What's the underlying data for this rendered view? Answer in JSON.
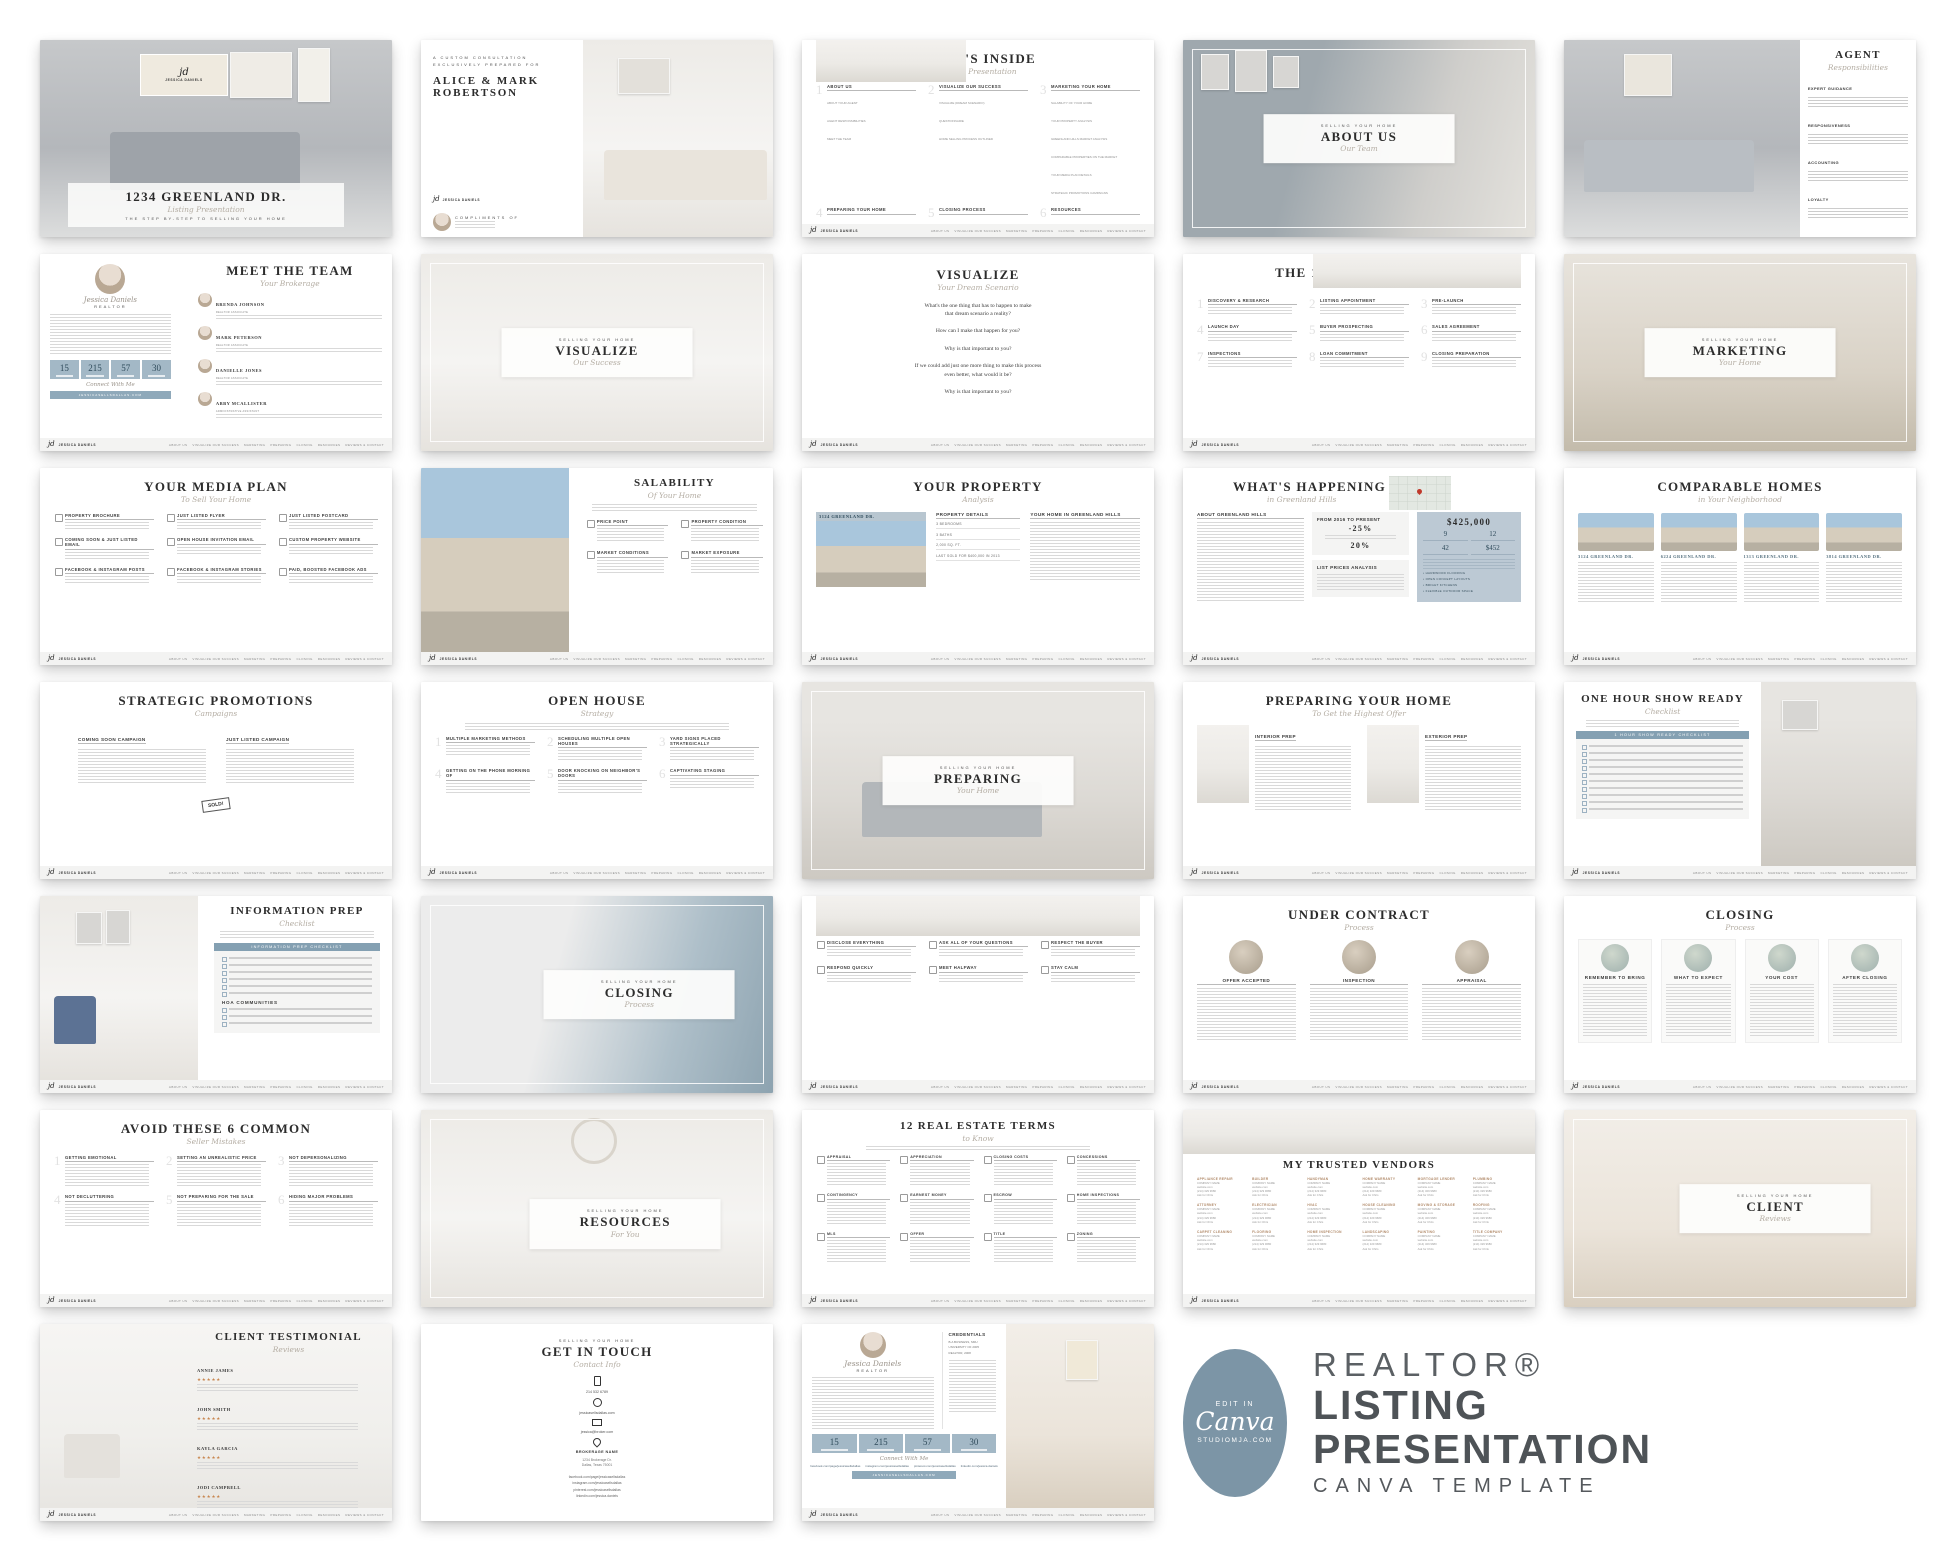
{
  "shared": {
    "eyebrow": "SELLING YOUR HOME",
    "connect": "Connect With Me",
    "stats": [
      "15",
      "215",
      "57",
      "30"
    ]
  },
  "logo": {
    "initials": "jd",
    "name": "JESSICA DANIELS"
  },
  "footer_nav": [
    "ABOUT US",
    "VISUALIZE OUR SUCCESS",
    "MARKETING",
    "PREPARING",
    "CLOSING",
    "RESOURCES",
    "REVIEWS & CONTACT"
  ],
  "branding": {
    "badge_top": "EDIT IN",
    "badge_logo": "Canva",
    "badge_site": "STUDIOMJA.COM",
    "line1": "REALTOR®",
    "line2": "LISTING",
    "line3": "PRESENTATION",
    "line4": "CANVA TEMPLATE"
  },
  "slides": {
    "cover": {
      "title": "1234 GREENLAND DR.",
      "script": "Listing Presentation",
      "tagline": "THE STEP BY-STEP TO SELLING YOUR HOME"
    },
    "intro": {
      "eyebrow": "A CUSTOM CONSULTATION\nEXCLUSIVELY PREPARED FOR",
      "name1": "ALICE & MARK",
      "name2": "ROBERTSON",
      "compliments": "COMPLIMENTS OF",
      "agent": "Jessica Daniels"
    },
    "whats_inside": {
      "title": "WHAT'S INSIDE",
      "script": "Sellers Presentation",
      "items": [
        {
          "h": "ABOUT US",
          "sub": "ABOUT YOUR AGENT\nAGENT RESPONSIBILITIES\nMEET THE TEAM"
        },
        {
          "h": "VISUALIZE OUR SUCCESS",
          "sub": "VISUALIZE (DREAM SCENARIO)\nQUESTIONNAIRE\nHOME SELLING PROCESS OUTLINED"
        },
        {
          "h": "MARKETING YOUR HOME",
          "sub": "SALABILITY OF YOUR HOME\nYOUR PROPERTY ANALYSIS\nGREENLAND HILLS MARKET ANALYSIS\nCOMPARABLE PROPERTIES ON THE MARKET\nYOUR MEDIA PLAN DETAILS\nSTRATEGIC PROMOTIONS CAMPAIGNS"
        },
        {
          "h": "PREPARING YOUR HOME",
          "sub": "HOW TO PREP INTERIOR & EXTERIOR\nONE HOUR SHOW READY\nINFORMATION PREP"
        },
        {
          "h": "CLOSING PROCESS",
          "sub": "NEGOTIATING THE SALE\nCLOSING 101\nUNDER CONTRACT PROCESS"
        },
        {
          "h": "RESOURCES",
          "sub": "REAL ESTATE TERMS TO KNOW\nTRUSTED VENDORS RESOURCES"
        },
        {
          "h": "REVIEWS & CONTACT",
          "sub": "OUR AWESOME CLIENTS REVIEWS\nCONTACT INFORMATION"
        }
      ]
    },
    "about_us": {
      "title": "ABOUT US",
      "script": "Our Team"
    },
    "agent_resp": {
      "title": "AGENT",
      "script": "Responsibilities",
      "sections": [
        "EXPERT GUIDANCE",
        "RESPONSIVENESS",
        "ACCOUNTING",
        "LOYALTY"
      ]
    },
    "meet_team": {
      "title": "MEET THE TEAM",
      "script": "Your Brokerage",
      "agent": "Jessica Daniels",
      "role": "REALTOR",
      "members": [
        {
          "name": "BRENDA JOHNSON",
          "role": "REALTOR ASSOCIATE"
        },
        {
          "name": "MARK PETERSON",
          "role": "REALTOR ASSOCIATE"
        },
        {
          "name": "DANIELLE JONES",
          "role": "REALTOR ASSOCIATE"
        },
        {
          "name": "ABBY MCALLISTER",
          "role": "ADMINISTRATIVE ASSISTANT"
        }
      ]
    },
    "visualize_photo": {
      "title": "VISUALIZE",
      "script": "Our Success"
    },
    "visualize_q": {
      "title": "VISUALIZE",
      "script": "Your Dream Scenario",
      "questions": [
        "What's the one thing that has to happen to make\nthat dream scenario a reality?",
        "How can I make that happen for you?",
        "Why is that important to you?",
        "If we could add just one more thing to make this process\neven better, what would it be?",
        "Why is that important to you?"
      ]
    },
    "ten_step": {
      "title": "THE 10-STEP PROCESS",
      "script": "To Sell Your Home",
      "steps": [
        "DISCOVERY & RESEARCH",
        "LISTING APPOINTMENT",
        "PRE-LAUNCH",
        "LAUNCH DAY",
        "BUYER PROSPECTING",
        "SALES AGREEMENT",
        "INSPECTIONS",
        "LOAN COMMITMENT",
        "CLOSING PREPARATION"
      ]
    },
    "marketing_photo": {
      "title": "MARKETING",
      "script": "Your Home"
    },
    "media_plan": {
      "title": "YOUR MEDIA PLAN",
      "script": "To Sell Your Home",
      "items": [
        "PROPERTY BROCHURE",
        "JUST LISTED FLYER",
        "JUST LISTED POSTCARD",
        "COMING SOON & JUST LISTED EMAIL",
        "OPEN HOUSE INVITATION EMAIL",
        "CUSTOM PROPERTY WEBSITE",
        "FACEBOOK & INSTAGRAM POSTS",
        "FACEBOOK & INSTAGRAM STORIES",
        "PAID, BOOSTED FACEBOOK ADS"
      ]
    },
    "salability": {
      "title": "SALABILITY",
      "script": "Of Your Home",
      "items": [
        "PRICE POINT",
        "PROPERTY CONDITION",
        "MARKET CONDITIONS",
        "MARKET EXPOSURE"
      ]
    },
    "your_property": {
      "title": "YOUR PROPERTY",
      "script": "Analysis",
      "address": "3124 GREENLAND DR.",
      "details_h": "PROPERTY DETAILS",
      "details": [
        "3 BEDROOMS",
        "3 BATHS",
        "2,000 SQ. FT.",
        "LAST SOLD FOR $400,000 IN 2013"
      ],
      "right_h": "YOUR HOME IN GREENLAND HILLS"
    },
    "whats_happening": {
      "title": "WHAT'S HAPPENING",
      "script": "in Greenland Hills",
      "about_h": "ABOUT GREENLAND HILLS",
      "from_h": "FROM 2016 TO PRESENT",
      "stat1": "-25%",
      "stat2": "20%",
      "list_h": "LIST PRICES ANALYSIS",
      "price": "$425,000",
      "side_stats": [
        "9",
        "12",
        "42",
        "$452"
      ],
      "bullets": [
        "HARDWOOD FLOORING",
        "OPEN CONCEPT LAYOUTS",
        "BRIGHT KITCHENS",
        "FLEXIBLE OUTDOOR SPACE"
      ]
    },
    "comparable": {
      "title": "COMPARABLE HOMES",
      "script": "in Your Neighborhood",
      "addresses": [
        "3124 GREENLAND DR.",
        "6224 GREENLAND DR.",
        "1313 GREENLAND DR.",
        "3814 GREENLAND DR."
      ]
    },
    "strategic": {
      "title": "STRATEGIC PROMOTIONS",
      "script": "Campaigns",
      "sections": [
        "COMING SOON CAMPAIGN",
        "JUST LISTED CAMPAIGN"
      ],
      "sold": "SOLD!"
    },
    "open_house": {
      "title": "OPEN HOUSE",
      "script": "Strategy",
      "items": [
        "MULTIPLE MARKETING METHODS",
        "SCHEDULING MULTIPLE OPEN HOUSES",
        "YARD SIGNS PLACED STRATEGICALLY",
        "GETTING ON THE PHONE MORNING OF",
        "DOOR KNOCKING ON NEIGHBOR'S DOORS",
        "CAPTIVATING STAGING"
      ]
    },
    "preparing_photo": {
      "title": "PREPARING",
      "script": "Your Home"
    },
    "preparing_home": {
      "title": "PREPARING YOUR HOME",
      "script": "To Get the Highest Offer",
      "cols": [
        "INTERIOR PREP",
        "EXTERIOR PREP"
      ]
    },
    "one_hour": {
      "title": "ONE HOUR SHOW READY",
      "script": "Checklist",
      "box_h": "1 HOUR SHOW READY CHECKLIST"
    },
    "info_prep": {
      "title": "INFORMATION PREP",
      "script": "Checklist",
      "box_h": "INFORMATION PREP CHECKLIST",
      "sub_h": "HOA COMMUNITIES"
    },
    "closing_photo": {
      "title": "CLOSING",
      "script": "Process"
    },
    "negotiating": {
      "title": "NEGOTIATING THE SALE",
      "script": "Successfully",
      "items": [
        "DISCLOSE EVERYTHING",
        "ASK ALL OF YOUR QUESTIONS",
        "RESPECT THE BUYER",
        "RESPOND QUICKLY",
        "MEET HALFWAY",
        "STAY CALM"
      ]
    },
    "under_contract": {
      "title": "UNDER CONTRACT",
      "script": "Process",
      "cols": [
        "OFFER ACCEPTED",
        "INSPECTION",
        "APPRAISAL"
      ]
    },
    "closing_process": {
      "title": "CLOSING",
      "script": "Process",
      "cols": [
        "REMEMBER TO BRING",
        "WHAT TO EXPECT",
        "YOUR COST",
        "AFTER CLOSING"
      ]
    },
    "mistakes": {
      "title": "AVOID THESE 6 COMMON",
      "script": "Seller Mistakes",
      "items": [
        "GETTING EMOTIONAL",
        "SETTING AN UNREALISTIC PRICE",
        "NOT DEPERSONALIZING",
        "NOT DECLUTTERING",
        "NOT PREPARING FOR THE SALE",
        "HIDING MAJOR PROBLEMS"
      ]
    },
    "resources_photo": {
      "title": "RESOURCES",
      "script": "For You"
    },
    "terms": {
      "title": "12 REAL ESTATE TERMS",
      "script": "to Know",
      "items": [
        "APPRAISAL",
        "APPRECIATION",
        "CLOSING COSTS",
        "CONCESSIONS",
        "CONTINGENCY",
        "EARNEST MONEY",
        "ESCROW",
        "HOME INSPECTIONS",
        "MLS",
        "OFFER",
        "TITLE",
        "ZONING"
      ]
    },
    "vendors": {
      "title": "MY TRUSTED VENDORS",
      "company": "COMPANY NAME",
      "website": "website.com",
      "phone": "(214) 329 9680",
      "contact": "Ask for Chris",
      "categories": [
        "APPLIANCE REPAIR",
        "BUILDER",
        "HANDYMAN",
        "HOME WARRANTY",
        "MORTGAGE LENDER",
        "PLUMBING",
        "ATTORNEY",
        "ELECTRICIAN",
        "HVAC",
        "HOUSE CLEANING",
        "MOVING & STORAGE",
        "ROOFING",
        "CARPET CLEANING",
        "FLOORING",
        "HOME INSPECTION",
        "LANDSCAPING",
        "PAINTING",
        "TITLE COMPANY"
      ]
    },
    "client_photo": {
      "title": "CLIENT",
      "script": "Reviews"
    },
    "testimonial": {
      "title": "CLIENT TESTIMONIAL",
      "script": "Reviews",
      "stars": "★★★★★",
      "names": [
        "ANNIE JAMES",
        "JOHN SMITH",
        "KAYLA GARCIA",
        "JODI CAMPBELL"
      ]
    },
    "get_in_touch": {
      "title": "GET IN TOUCH",
      "script": "Contact Info",
      "phone": "214 532 6789",
      "website": "jessicasellsdallas.com",
      "email": "jessica@broker.com",
      "brokerage": "BROKERAGE NAME",
      "address": "1234 Brokerage Dr.\nDallas, Texas 75001",
      "socials": [
        "facebook.com/page/jessicasellsdallas",
        "instagram.com/jessicasellsdallas",
        "pinterest.com/jessicasellsdallas",
        "linkedin.com/jessica.daniels"
      ]
    },
    "agent_bio": {
      "agent": "Jessica Daniels",
      "role": "REALTOR",
      "cred_h": "CREDENTIALS",
      "creds": "B.A BUSINESS, SMU\nUNIVERSITY OF 2005\nREALTOR, 2008",
      "button": "JESSICASELLSDALLAS.COM"
    }
  }
}
